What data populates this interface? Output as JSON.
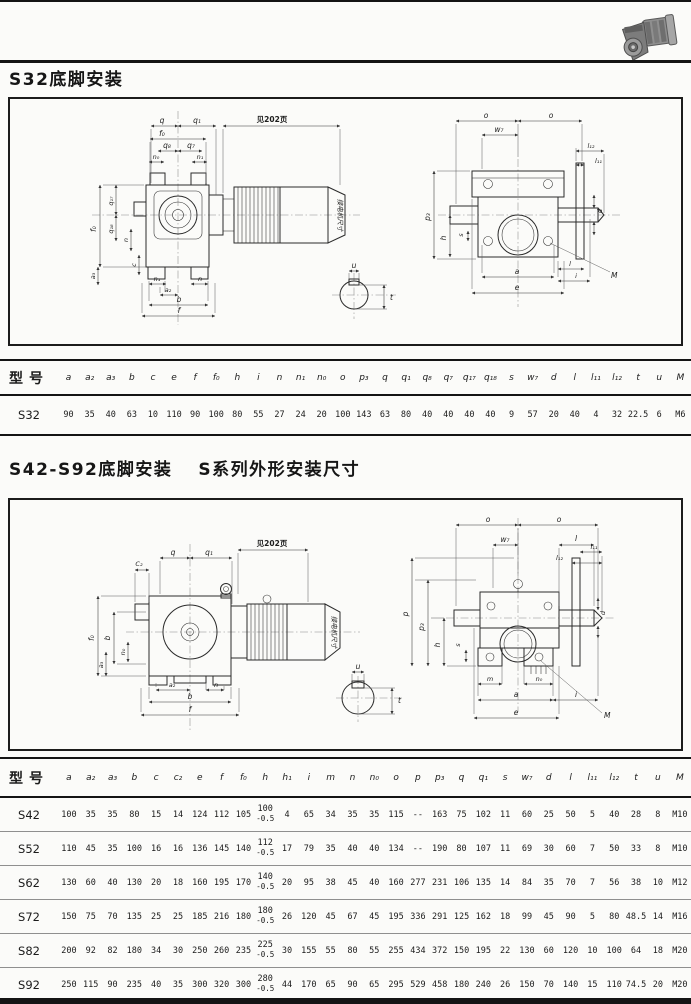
{
  "page": {
    "heading1": "S32底脚安装",
    "heading2a": "S42-S92底脚安装",
    "heading2b": "S系列外形安装尺寸"
  },
  "d1": {
    "note": "见202页",
    "motor": "接电机尺寸",
    "q": "q",
    "q1": "q₁",
    "f0": "f₀",
    "q8": "q₈",
    "q7": "q₇",
    "n0": "n₀",
    "n1": "n₁",
    "q17": "q₁₇",
    "q18": "q₁₈",
    "n": "n",
    "a3": "a₃",
    "c": "c",
    "a2": "a₂",
    "b": "b",
    "f": "f",
    "o": "o",
    "w7": "w₇",
    "l12": "l₁₂",
    "l11": "l₁₁",
    "p3": "p₃",
    "h": "h",
    "s": "s",
    "d": "d",
    "l": "l",
    "a": "a",
    "i": "i",
    "e": "e",
    "M": "M",
    "u": "u",
    "t": "t"
  },
  "d2": {
    "note": "见202页",
    "motor": "接电机尺寸",
    "c2": "C₂",
    "q": "q",
    "q1": "q₁",
    "f0": "f₀",
    "b": "b",
    "n0": "n₀",
    "a3": "a₃",
    "a2": "a₂",
    "n": "n",
    "f": "f",
    "o": "o",
    "w7": "w₇",
    "l": "l",
    "l12": "l₁₂",
    "l11": "l₁₁",
    "p": "p",
    "p3": "p₃",
    "h": "h",
    "s": "s",
    "d": "d",
    "m": "m",
    "a": "a",
    "i": "i",
    "e": "e",
    "M": "M",
    "u": "u",
    "t": "t"
  },
  "table1": {
    "model_header": "型号",
    "columns": [
      "a",
      "a₂",
      "a₃",
      "b",
      "c",
      "e",
      "f",
      "f₀",
      "h",
      "i",
      "n",
      "n₁",
      "n₀",
      "o",
      "p₃",
      "q",
      "q₁",
      "q₈",
      "q₇",
      "q₁₇",
      "q₁₈",
      "s",
      "w₇",
      "d",
      "l",
      "l₁₁",
      "l₁₂",
      "t",
      "u",
      "M"
    ],
    "rows": [
      {
        "model": "S32",
        "values": [
          "90",
          "35",
          "40",
          "63",
          "10",
          "110",
          "90",
          "100",
          "80",
          "55",
          "27",
          "24",
          "20",
          "100",
          "143",
          "63",
          "80",
          "40",
          "40",
          "40",
          "40",
          "9",
          "57",
          "20",
          "40",
          "4",
          "32",
          "22.5",
          "6",
          "M6"
        ]
      }
    ]
  },
  "table2": {
    "model_header": "型号",
    "columns": [
      "a",
      "a₂",
      "a₃",
      "b",
      "c",
      "c₂",
      "e",
      "f",
      "f₀",
      "h",
      "h₁",
      "i",
      "m",
      "n",
      "n₀",
      "o",
      "p",
      "p₃",
      "q",
      "q₁",
      "s",
      "w₇",
      "d",
      "l",
      "l₁₁",
      "l₁₂",
      "t",
      "u",
      "M"
    ],
    "rows": [
      {
        "model": "S42",
        "values": [
          "100",
          "35",
          "35",
          "80",
          "15",
          "14",
          "124",
          "112",
          "105",
          [
            "100",
            "-0.5"
          ],
          "4",
          "65",
          "34",
          "35",
          "35",
          "115",
          "--",
          "163",
          "75",
          "102",
          "11",
          "60",
          "25",
          "50",
          "5",
          "40",
          "28",
          "8",
          "M10"
        ]
      },
      {
        "model": "S52",
        "values": [
          "110",
          "45",
          "35",
          "100",
          "16",
          "16",
          "136",
          "145",
          "140",
          [
            "112",
            "-0.5"
          ],
          "17",
          "79",
          "35",
          "40",
          "40",
          "134",
          "--",
          "190",
          "80",
          "107",
          "11",
          "69",
          "30",
          "60",
          "7",
          "50",
          "33",
          "8",
          "M10"
        ]
      },
      {
        "model": "S62",
        "values": [
          "130",
          "60",
          "40",
          "130",
          "20",
          "18",
          "160",
          "195",
          "170",
          [
            "140",
            "-0.5"
          ],
          "20",
          "95",
          "38",
          "45",
          "40",
          "160",
          "277",
          "231",
          "106",
          "135",
          "14",
          "84",
          "35",
          "70",
          "7",
          "56",
          "38",
          "10",
          "M12"
        ]
      },
      {
        "model": "S72",
        "values": [
          "150",
          "75",
          "70",
          "135",
          "25",
          "25",
          "185",
          "216",
          "180",
          [
            "180",
            "-0.5"
          ],
          "26",
          "120",
          "45",
          "67",
          "45",
          "195",
          "336",
          "291",
          "125",
          "162",
          "18",
          "99",
          "45",
          "90",
          "5",
          "80",
          "48.5",
          "14",
          "M16"
        ]
      },
      {
        "model": "S82",
        "values": [
          "200",
          "92",
          "82",
          "180",
          "34",
          "30",
          "250",
          "260",
          "235",
          [
            "225",
            "-0.5"
          ],
          "30",
          "155",
          "55",
          "80",
          "55",
          "255",
          "434",
          "372",
          "150",
          "195",
          "22",
          "130",
          "60",
          "120",
          "10",
          "100",
          "64",
          "18",
          "M20"
        ]
      },
      {
        "model": "S92",
        "values": [
          "250",
          "115",
          "90",
          "235",
          "40",
          "35",
          "300",
          "320",
          "300",
          [
            "280",
            "-0.5"
          ],
          "44",
          "170",
          "65",
          "90",
          "65",
          "295",
          "529",
          "458",
          "180",
          "240",
          "26",
          "150",
          "70",
          "140",
          "15",
          "110",
          "74.5",
          "20",
          "M20"
        ]
      }
    ]
  }
}
